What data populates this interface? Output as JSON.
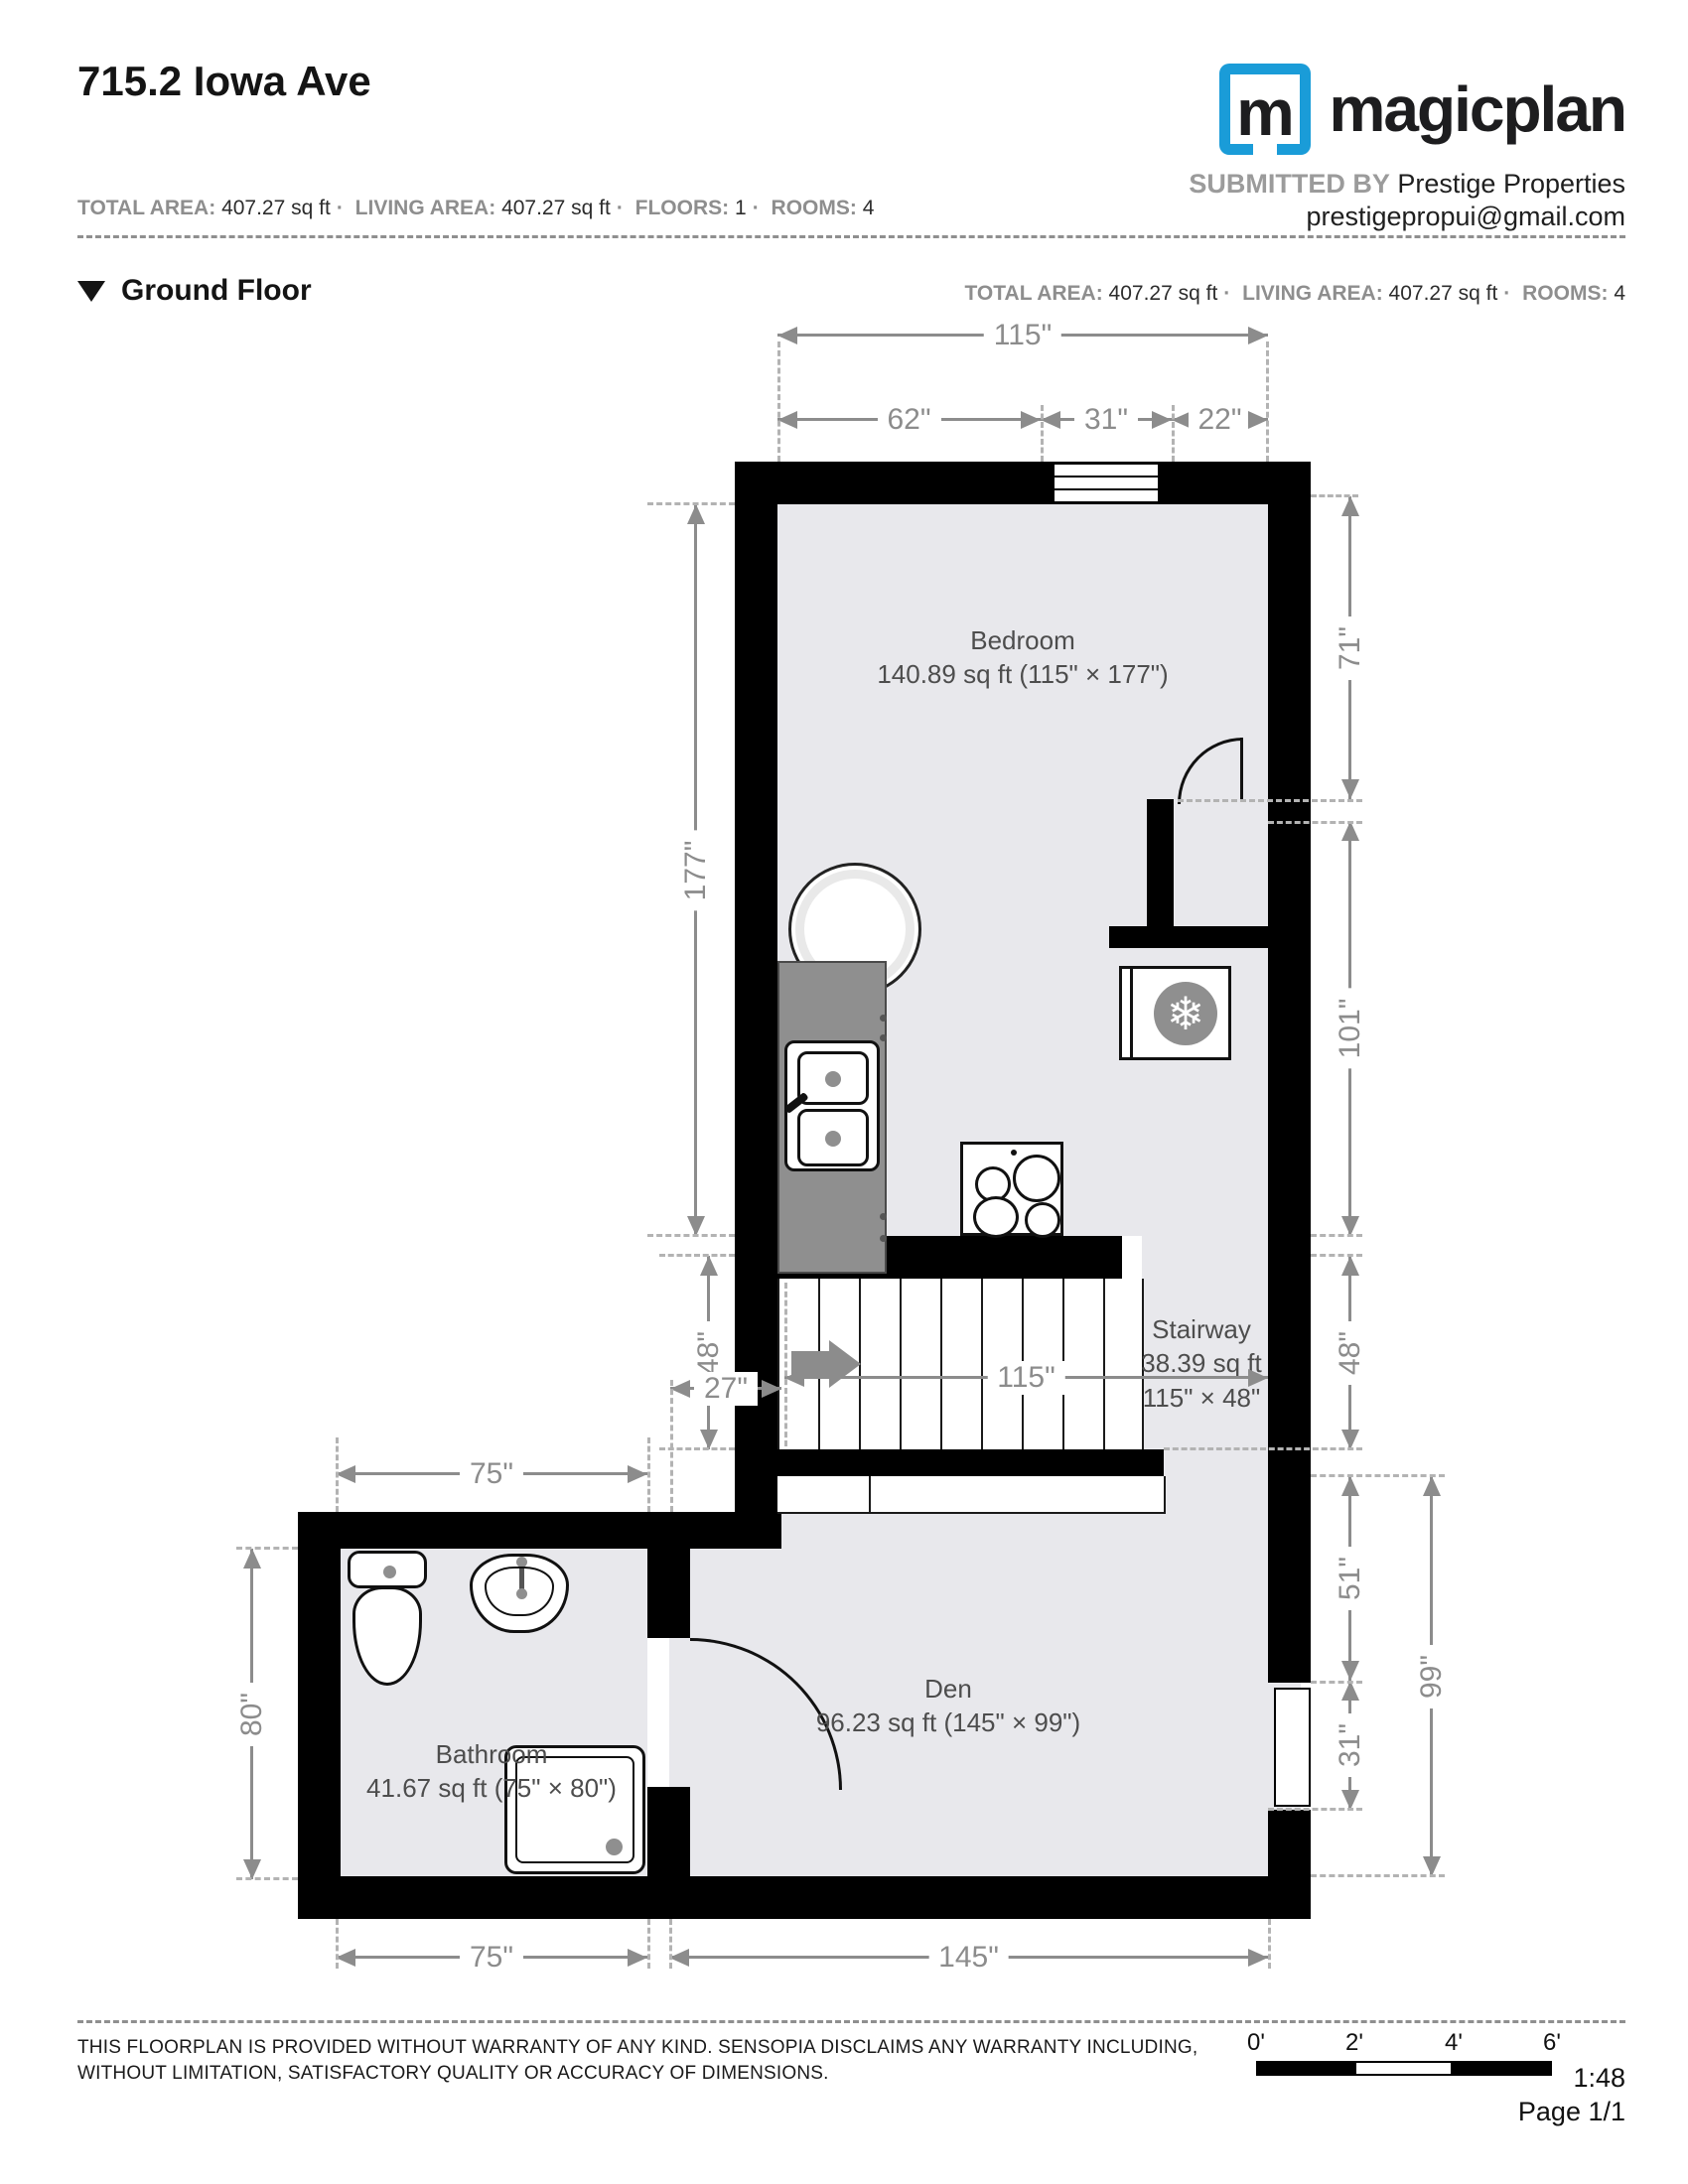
{
  "colors": {
    "brand_blue": "#1a9cd8",
    "wall_black": "#000000",
    "floor_gray": "#e8e8ec",
    "dim_gray": "#8c8c8c"
  },
  "header": {
    "title": "715.2 Iowa Ave",
    "logo": {
      "letter": "m",
      "wordmark": "magicplan"
    },
    "submitted_by_label": "SUBMITTED BY",
    "submitted_by": "Prestige Properties",
    "email": "prestigepropui@gmail.com",
    "stats": [
      {
        "label": "TOTAL AREA:",
        "value": "407.27 sq ft"
      },
      {
        "label": "LIVING AREA:",
        "value": "407.27 sq ft"
      },
      {
        "label": "FLOORS:",
        "value": "1"
      },
      {
        "label": "ROOMS:",
        "value": "4"
      }
    ]
  },
  "floor_section": {
    "title": "Ground Floor",
    "stats": [
      {
        "label": "TOTAL AREA:",
        "value": "407.27 sq ft"
      },
      {
        "label": "LIVING AREA:",
        "value": "407.27 sq ft"
      },
      {
        "label": "ROOMS:",
        "value": "4"
      }
    ]
  },
  "rooms": {
    "bedroom": {
      "name": "Bedroom",
      "area": "140.89 sq ft (115\" × 177\")"
    },
    "stairway": {
      "name": "Stairway",
      "area": "38.39 sq ft",
      "size": "115\" × 48\""
    },
    "bathroom": {
      "name": "Bathroom",
      "area": "41.67 sq ft (75\" × 80\")"
    },
    "den": {
      "name": "Den",
      "area": "96.23 sq ft (145\" × 99\")"
    }
  },
  "dimensions": {
    "top_total": "115\"",
    "top_left": "62\"",
    "top_mid": "31\"",
    "top_right": "22\"",
    "left_bedroom": "177\"",
    "left_stair": "48\"",
    "left_offset": "27\"",
    "right_upper": "71\"",
    "right_mid": "101\"",
    "right_stair": "48\"",
    "right_den_upper": "51\"",
    "right_den_lower": "31\"",
    "right_den_total": "99\"",
    "stair_width": "115\"",
    "bath_top": "75\"",
    "bath_left": "80\"",
    "bottom_bath": "75\"",
    "bottom_den": "145\""
  },
  "footer": {
    "disclaimer_line1": "THIS FLOORPLAN IS PROVIDED WITHOUT WARRANTY OF ANY KIND. SENSOPIA DISCLAIMS ANY WARRANTY INCLUDING,",
    "disclaimer_line2": "WITHOUT LIMITATION, SATISFACTORY QUALITY OR ACCURACY OF DIMENSIONS.",
    "scale_ticks": [
      "0'",
      "2'",
      "4'",
      "6'"
    ],
    "scale_ratio": "1:48",
    "page": "Page 1/1"
  }
}
